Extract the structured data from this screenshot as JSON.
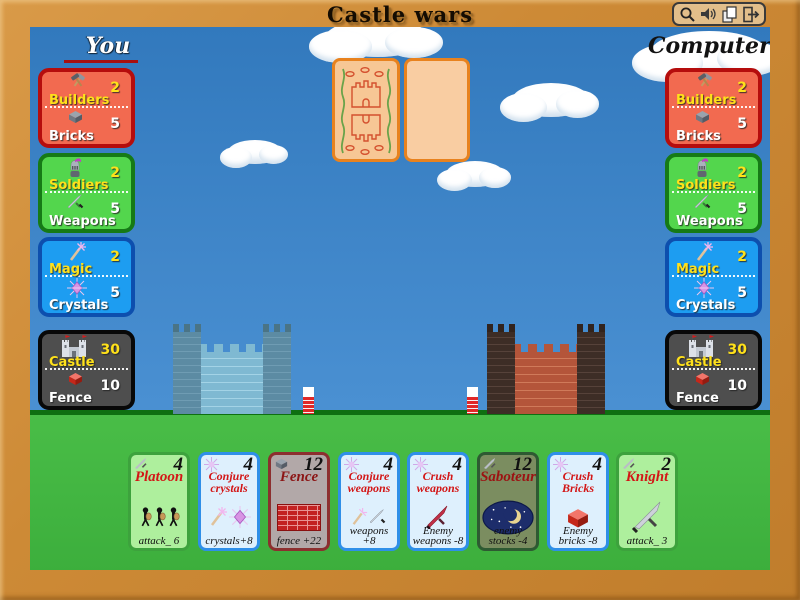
{
  "window": {
    "title": "Castle wars",
    "controls": {
      "icons": [
        "magnifier-icon",
        "speaker-icon",
        "pages-icon",
        "exit-icon"
      ]
    }
  },
  "players": {
    "you": {
      "label": "You",
      "stats": {
        "builders": {
          "label1": "Builders",
          "value1": "2",
          "label2": "Bricks",
          "value2": "5"
        },
        "soldiers": {
          "label1": "Soldiers",
          "value1": "2",
          "label2": "Weapons",
          "value2": "5"
        },
        "magic": {
          "label1": "Magic",
          "value1": "2",
          "label2": "Crystals",
          "value2": "5"
        },
        "castle": {
          "label1": "Castle",
          "value1": "30",
          "label2": "Fence",
          "value2": "10"
        }
      }
    },
    "computer": {
      "label": "Computer",
      "stats": {
        "builders": {
          "label1": "Builders",
          "value1": "2",
          "label2": "Bricks",
          "value2": "5"
        },
        "soldiers": {
          "label1": "Soldiers",
          "value1": "2",
          "label2": "Weapons",
          "value2": "5"
        },
        "magic": {
          "label1": "Magic",
          "value1": "2",
          "label2": "Crystals",
          "value2": "5"
        },
        "castle": {
          "label1": "Castle",
          "value1": "30",
          "label2": "Fence",
          "value2": "10"
        }
      }
    }
  },
  "hand": {
    "cards": [
      {
        "name": "Platoon",
        "cost": "4",
        "effect": "attack_ 6"
      },
      {
        "name": "Conjure crystals",
        "cost": "4",
        "effect": "crystals+8"
      },
      {
        "name": "Fence",
        "cost": "12",
        "effect": "fence +22"
      },
      {
        "name": "Conjure weapons",
        "cost": "4",
        "effect": "weapons +8"
      },
      {
        "name": "Crush weapons",
        "cost": "4",
        "effect": "Enemy weapons -8"
      },
      {
        "name": "Saboteur",
        "cost": "12",
        "effect": "enemy stocks -4"
      },
      {
        "name": "Crush Bricks",
        "cost": "4",
        "effect": "Enemy bricks -8"
      },
      {
        "name": "Knight",
        "cost": "2",
        "effect": "attack_ 3"
      }
    ]
  },
  "palette": {
    "frame": "#cd8a36",
    "sky": "#3a82c4",
    "grass": "#3fb23f",
    "red_panel": "#f26a50",
    "green_panel": "#53d64d",
    "blue_panel": "#1d9df1",
    "dark_panel": "#4e4e4e",
    "card_back_border": "#e8821e",
    "you_underline": "#a80f0f"
  }
}
